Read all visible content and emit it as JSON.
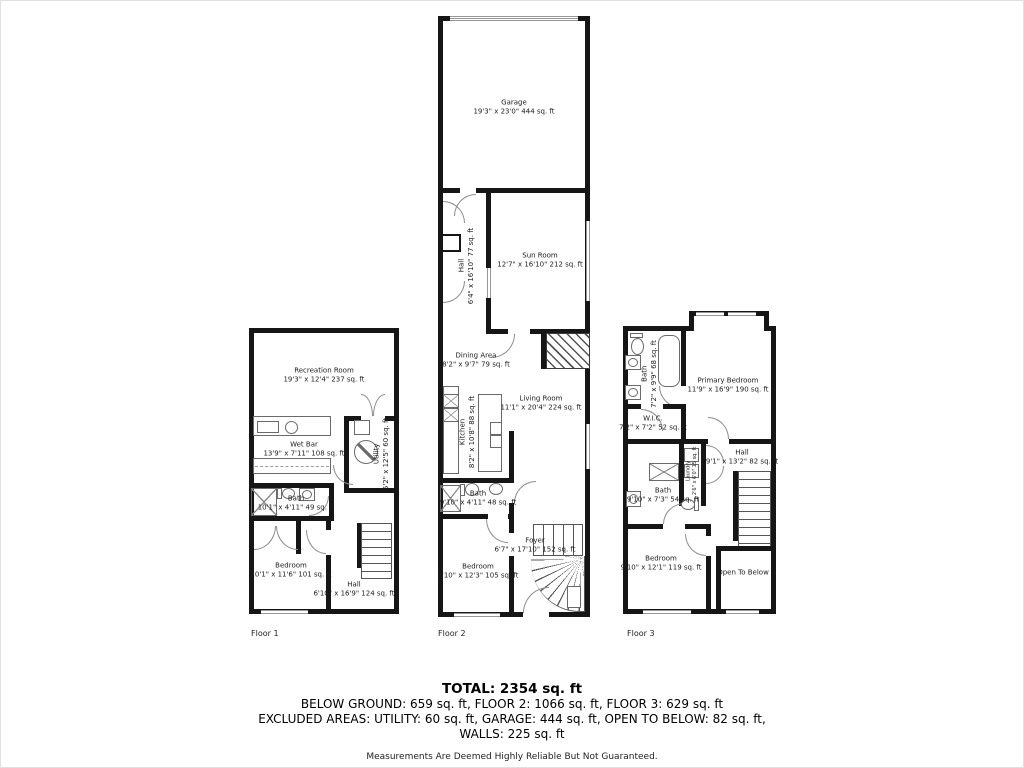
{
  "floor1": {
    "label": "Floor 1",
    "recreation_room": {
      "name": "Recreation Room",
      "dims": "19'3\" x 12'4\" 237 sq. ft"
    },
    "wet_bar": {
      "name": "Wet Bar",
      "dims": "13'9\" x 7'11\" 108 sq. ft"
    },
    "utility": {
      "name": "Utility",
      "dims": "5'2\" x 12'5\" 60 sq. ft"
    },
    "bath": {
      "name": "Bath",
      "dims": "10'1\" x 4'11\" 49 sq. ft"
    },
    "bedroom": {
      "name": "Bedroom",
      "dims": "10'1\" x 11'6\" 101 sq. ft"
    },
    "hall": {
      "name": "Hall",
      "dims": "6'10\" x 16'9\" 124 sq. ft"
    }
  },
  "floor2": {
    "label": "Floor 2",
    "garage": {
      "name": "Garage",
      "dims": "19'3\" x 23'0\" 444 sq. ft"
    },
    "hall": {
      "name": "Hall",
      "dims": "6'4\" x 16'10\" 77 sq. ft"
    },
    "sun_room": {
      "name": "Sun Room",
      "dims": "12'7\" x 16'10\" 212 sq. ft"
    },
    "dining_area": {
      "name": "Dining Area",
      "dims": "8'2\" x 9'7\" 79 sq. ft"
    },
    "living_room": {
      "name": "Living Room",
      "dims": "11'1\" x 20'4\" 224 sq. ft"
    },
    "kitchen": {
      "name": "Kitchen",
      "dims": "8'2\" x 10'8\" 88 sq. ft"
    },
    "bath": {
      "name": "Bath",
      "dims": "9'10\" x 4'11\" 48 sq. ft"
    },
    "foyer": {
      "name": "Foyer",
      "dims": "6'7\" x 17'10\" 152 sq. ft"
    },
    "bedroom": {
      "name": "Bedroom",
      "dims": "9'10\" x 12'3\" 105 sq. ft"
    }
  },
  "floor3": {
    "label": "Floor 3",
    "bath_upper": {
      "name": "Bath",
      "dims": "7'2\" x 9'9\" 68 sq. ft"
    },
    "primary_bedroom": {
      "name": "Primary Bedroom",
      "dims": "11'9\" x 16'9\" 190 sq. ft"
    },
    "wic": {
      "name": "W.I.C.",
      "dims": "7'2\" x 7'2\" 52 sq. ft"
    },
    "laundry": {
      "name": "Laundry",
      "dims": "2'6\" x 6'0\" 15 sq. ft"
    },
    "hall": {
      "name": "Hall",
      "dims": "9'1\" x 13'2\" 82 sq. ft"
    },
    "bath_lower": {
      "name": "Bath",
      "dims": "9'10\" x 7'3\" 54 sq. ft"
    },
    "bedroom": {
      "name": "Bedroom",
      "dims": "9'10\" x 12'1\" 119 sq. ft"
    },
    "open_to_below": {
      "name": "Open To Below"
    }
  },
  "summary": {
    "total": "TOTAL: 2354 sq. ft",
    "floors_line": "BELOW GROUND: 659 sq. ft, FLOOR 2: 1066 sq. ft, FLOOR 3: 629 sq. ft",
    "excluded_line": "EXCLUDED AREAS: UTILITY: 60 sq. ft, GARAGE: 444 sq. ft, OPEN TO BELOW: 82 sq. ft,",
    "walls_line": "WALLS: 225 sq. ft",
    "disclaimer": "Measurements Are Deemed Highly Reliable But Not Guaranteed."
  },
  "colors": {
    "wall": "#161616",
    "background": "#ffffff"
  }
}
